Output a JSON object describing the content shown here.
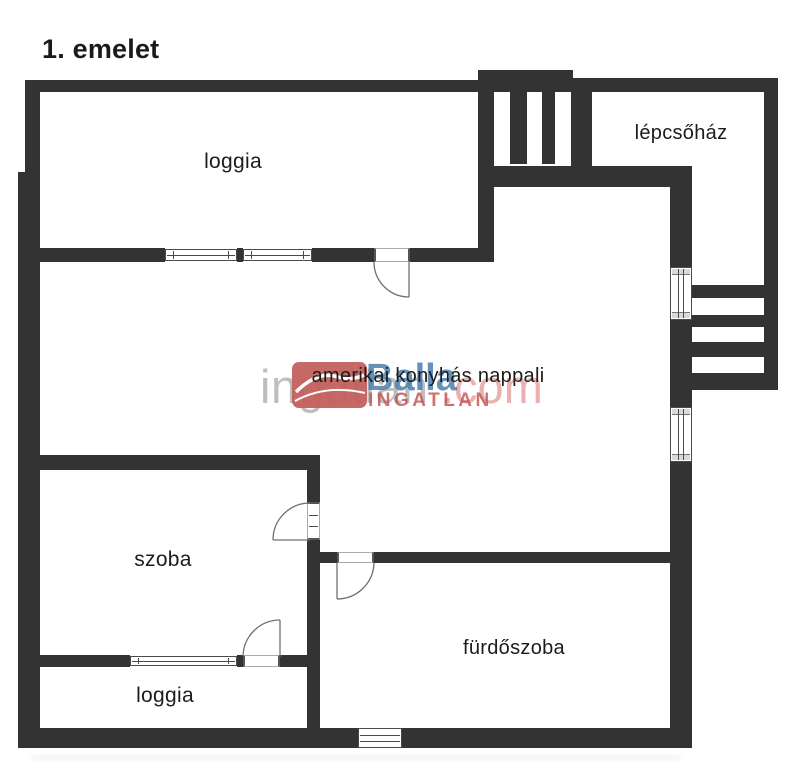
{
  "title": "1. emelet",
  "rooms": {
    "loggia_top": {
      "label": "loggia"
    },
    "lepcsohaz": {
      "label": "lépcsőház"
    },
    "nappali": {
      "label": "amerikai konyhás nappali"
    },
    "szoba": {
      "label": "szoba"
    },
    "furdoszoba": {
      "label": "fürdőszoba"
    },
    "loggia_bottom": {
      "label": "loggia"
    }
  },
  "watermark": {
    "site_text": "ingatlan",
    "site_suffix": ".com",
    "brand_name": "Balla",
    "brand_subtitle": "INGATLAN"
  },
  "theme": {
    "wall_color": "#333333",
    "background": "#ffffff",
    "label_color": "#1c1c1c",
    "watermark_gray": "#a6a6a6",
    "watermark_pink": "#e59e9b",
    "brand_red": "#c4605d",
    "brand_blue": "#4c7fae",
    "brand_darkred": "#c2504e"
  }
}
